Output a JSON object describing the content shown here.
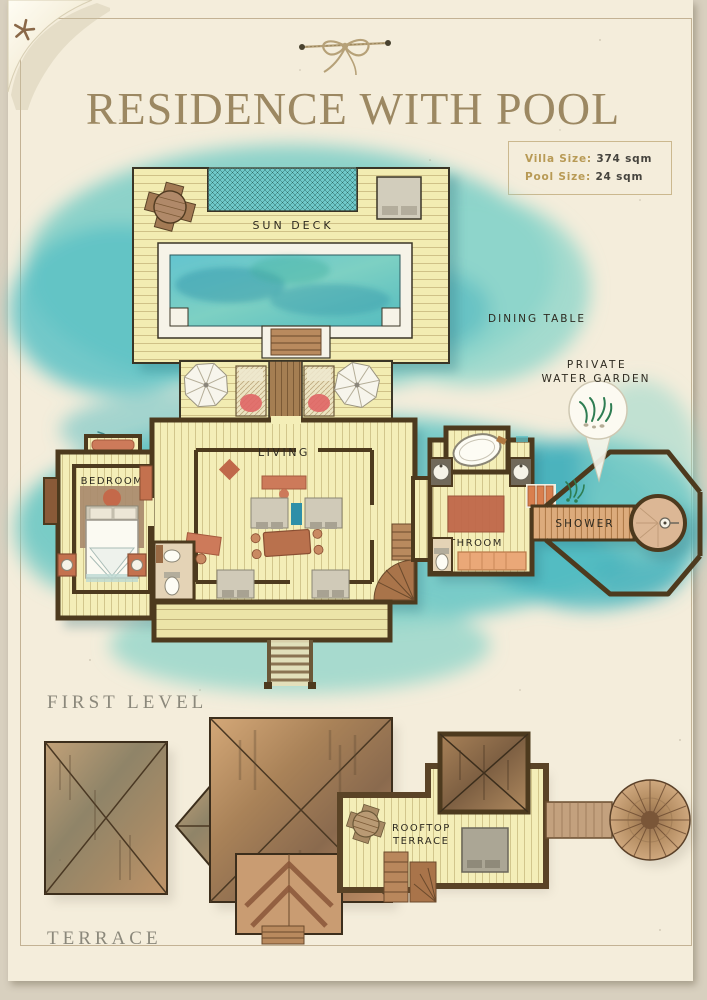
{
  "header": {
    "title": "RESIDENCE WITH POOL"
  },
  "info_box": {
    "villa_size_label": "Villa Size:",
    "villa_size_value": "374 sqm",
    "pool_size_label": "Pool Size:",
    "pool_size_value": "24 sqm"
  },
  "sections": {
    "first_level": "FIRST LEVEL",
    "terrace": "TERRACE"
  },
  "labels": {
    "sun_deck": "SUN DECK",
    "dining_table": "DINING TABLE",
    "private": "PRIVATE",
    "water_garden": "WATER GARDEN",
    "living": "LIVING",
    "bedroom": "BEDROOM",
    "bathroom": "BATHROOM",
    "shower": "SHOWER",
    "rooftop_line1": "ROOFTOP",
    "rooftop_line2": "TERRACE"
  },
  "icons": {
    "starfish": "starfish-icon",
    "twine_bow": "twine-bow-decoration",
    "parasol": "parasol-icon",
    "water_garden_callout": "water-garden-callout-icon",
    "thatch_roof": "thatch-umbrella-roof-icon"
  },
  "colors": {
    "paper": "#f4eddb",
    "background": "#d8d0bf",
    "frame": "#c3b294",
    "title": "#9c8862",
    "gold_label": "#b89a55",
    "water": "#6ec7c3",
    "pool": "#5fc0c6",
    "deck": "#f2ebb0",
    "wall": "#4d3a1e",
    "terracotta": "#c4714e",
    "roof": "#b18a5f",
    "section_label": "#8b887b"
  }
}
